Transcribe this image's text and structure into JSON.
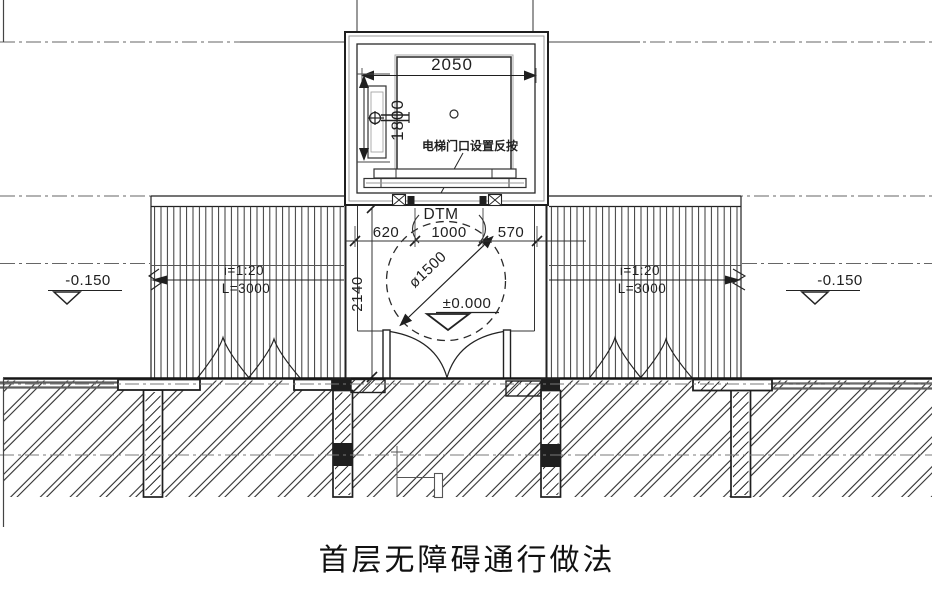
{
  "title": {
    "text": "首层无障碍通行做法"
  },
  "elevator": {
    "width_dim": "2050",
    "depth_dim": "1800",
    "door_note": "电梯门口设置反按",
    "door_code": "DTM"
  },
  "landing": {
    "dim_left": "620",
    "dim_center": "1000",
    "dim_right": "570",
    "depth_dim": "2140",
    "turning_circle_dia": "ø1500",
    "level": "±0.000"
  },
  "ramp_left": {
    "slope": "i=1:20",
    "length": "L=3000"
  },
  "ramp_right": {
    "slope": "i=1:20",
    "length": "L=3000"
  },
  "ground_left": {
    "level": "-0.150"
  },
  "ground_right": {
    "level": "-0.150"
  },
  "colors": {
    "line": "#1f1f1f",
    "grey": "#777777",
    "background": "#ffffff"
  }
}
